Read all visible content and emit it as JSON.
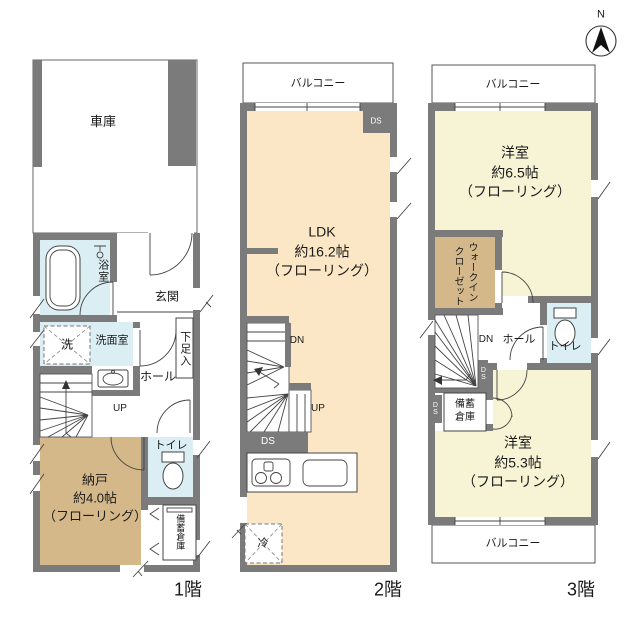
{
  "compass": {
    "north": "N"
  },
  "colors": {
    "wall": "#7b7b7b",
    "ldk_floor": "#fbe7c6",
    "bedroom_floor": "#f7f3d5",
    "closet_floor": "#d5b88a",
    "wet_area_floor": "#daeef3",
    "line": "#333333",
    "background": "#ffffff"
  },
  "f1": {
    "floor_label": "1階",
    "garage": "車庫",
    "bath": "浴室",
    "entrance": "玄関",
    "washer": "洗",
    "washroom": "洗面室",
    "shoe_box": "下足入",
    "hall": "ホール",
    "up": "UP",
    "storeroom": {
      "name": "納戸",
      "size": "約4.0帖",
      "finish": "（フローリング）"
    },
    "toilet": "トイレ",
    "stock": "備蓄倉庫"
  },
  "f2": {
    "floor_label": "2階",
    "balcony": "バルコニー",
    "ds_top": "DS",
    "ldk": {
      "name": "LDK",
      "size": "約16.2帖",
      "finish": "（フローリング）"
    },
    "dn": "DN",
    "up": "UP",
    "ds_bottom": "DS",
    "fridge": "冷"
  },
  "f3": {
    "floor_label": "3階",
    "balcony_top": "バルコニー",
    "bedroom_a": {
      "name": "洋室",
      "size": "約6.5帖",
      "finish": "（フローリング）"
    },
    "wic_col1": "ウォークイン",
    "wic_col2": "クローゼット",
    "dn": "DN",
    "hall": "ホール",
    "toilet": "トイレ",
    "ds_a": "DS",
    "ds_b": "DS",
    "stock_line1": "備蓄",
    "stock_line2": "倉庫",
    "bedroom_b": {
      "name": "洋室",
      "size": "約5.3帖",
      "finish": "（フローリング）"
    },
    "balcony_bottom": "バルコニー"
  }
}
